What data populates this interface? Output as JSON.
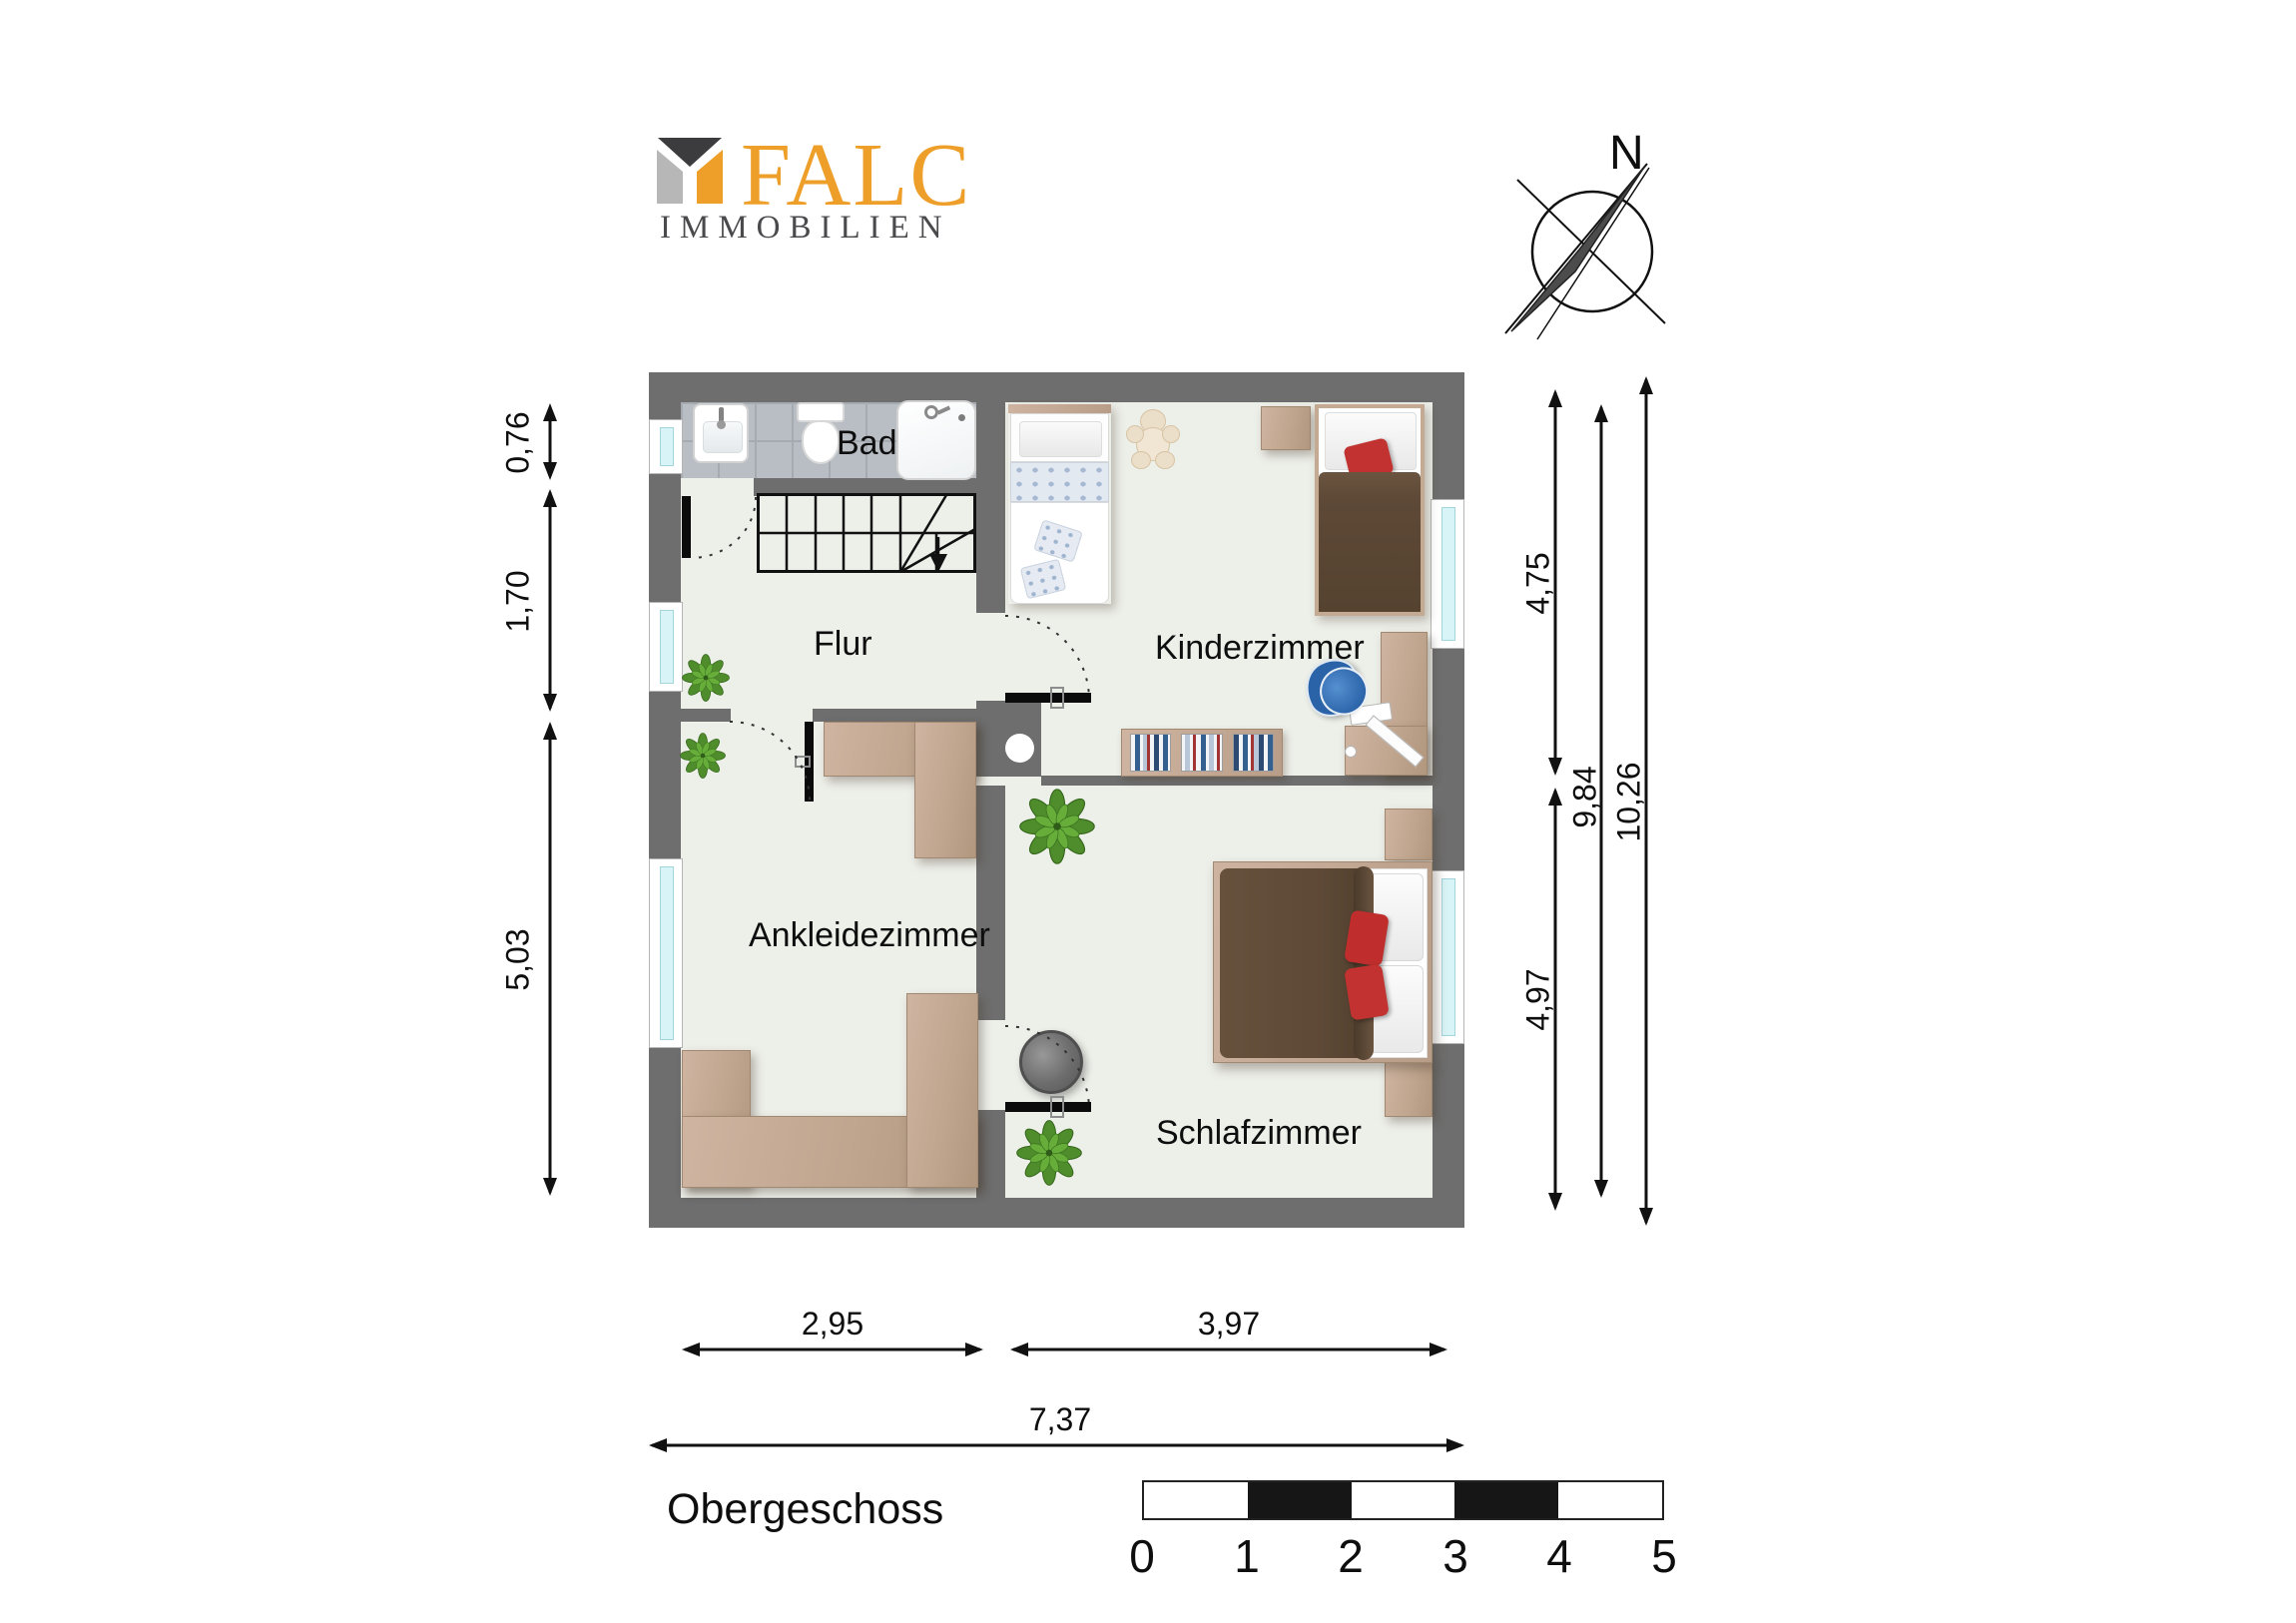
{
  "branding": {
    "logo_text": "FALC",
    "logo_subtitle": "IMMOBILIEN",
    "logo_mark": "house-cube-icon"
  },
  "compass": {
    "north_label": "N",
    "icon": "compass-needle-icon"
  },
  "plan": {
    "title": "Obergeschoss",
    "rooms": [
      {
        "name": "Bad",
        "furniture": [
          "washbasin",
          "toilet",
          "shower"
        ]
      },
      {
        "name": "Flur",
        "furniture": [
          "staircase",
          "plant"
        ]
      },
      {
        "name": "Kinderzimmer",
        "furniture": [
          "single-bed-white",
          "single-bed-brown",
          "teddy-bear",
          "side-table",
          "bookshelf",
          "corner-desk",
          "desk-chair"
        ]
      },
      {
        "name": "Ankleidezimmer",
        "furniture": [
          "wardrobe-l-shape",
          "wardrobe-u-shape",
          "plant"
        ]
      },
      {
        "name": "Schlafzimmer",
        "furniture": [
          "double-bed",
          "nightstand",
          "nightstand",
          "laundry-basket",
          "plant",
          "plant"
        ]
      }
    ],
    "dimensions": {
      "left": [
        {
          "label": "0,76"
        },
        {
          "label": "1,70"
        },
        {
          "label": "5,03"
        }
      ],
      "right": [
        {
          "label": "4,75"
        },
        {
          "label": "4,97"
        },
        {
          "label": "9,84"
        },
        {
          "label": "10,26"
        }
      ],
      "bottom": [
        {
          "label": "2,95"
        },
        {
          "label": "3,97"
        },
        {
          "label": "7,37"
        }
      ]
    }
  },
  "scale_bar": {
    "ticks": [
      "0",
      "1",
      "2",
      "3",
      "4",
      "5"
    ]
  },
  "colors": {
    "wall": "#6e6e6e",
    "floor": "#edefe9",
    "tile": "#b9bec4",
    "wood": "#c3a892",
    "accent_orange": "#ee9f2a",
    "plant_green": "#4e8c2c",
    "bed_brown": "#5d4936",
    "pillow_red": "#c23230",
    "window_glass": "#d9f4f6",
    "chair_blue": "#2a63a8"
  }
}
